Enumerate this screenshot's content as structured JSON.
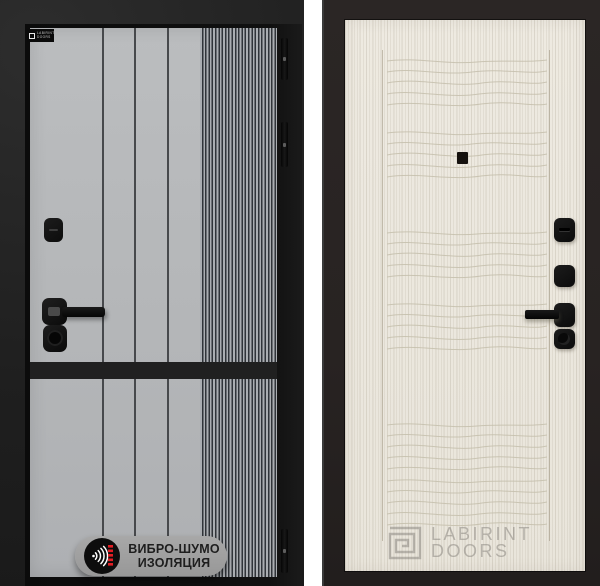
{
  "colors": {
    "left_bg": "#1f1f1f",
    "left_frame": "#0c0c0c",
    "left_panel": "#b6b8ba",
    "stripe_dark": "#303439",
    "pill_bg": "#a1a1a1",
    "pill_text": "#1e1e1e",
    "accent_red": "#e31e24",
    "right_bg": "#282322",
    "right_panel": "#ebe7de",
    "hardware_black": "#121212",
    "watermark_gray": "#7d7a73"
  },
  "left_door": {
    "brand_badge": {
      "line1": "LABIRINT",
      "line2": "DOORS"
    },
    "feature_badge": {
      "line1": "ВИБРО-ШУМО",
      "line2": "ИЗОЛЯЦИЯ",
      "icon": "sound-insulation-icon"
    }
  },
  "right_door": {
    "wave_bands_y": [
      35,
      107,
      207,
      279,
      399,
      455
    ]
  },
  "watermark": {
    "line1": "LABIRINT",
    "line2": "DOORS",
    "icon": "labyrinth-logo-icon"
  }
}
